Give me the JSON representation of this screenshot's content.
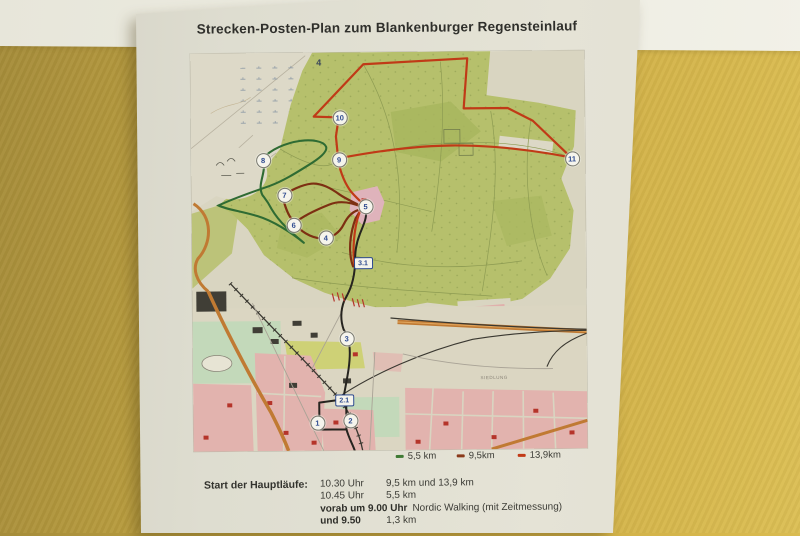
{
  "wall": {
    "band_color": "#f1f0e7",
    "yellow_color": "#ccab44"
  },
  "poster": {
    "title": "Strecken-Posten-Plan zum Blankenburger Regensteinlauf",
    "legend": {
      "items": [
        {
          "label": "5,5 km",
          "color": "#3f7a35"
        },
        {
          "label": "9,5km",
          "color": "#8a3a1a"
        },
        {
          "label": "13,9km",
          "color": "#c23a17"
        }
      ]
    },
    "schedule": {
      "heading": "Start der Hauptläufe:",
      "rows": [
        {
          "time": "10.30 Uhr",
          "detail": "9,5 km und 13,9 km"
        },
        {
          "time": "10.45 Uhr",
          "detail": "5,5 km"
        },
        {
          "time": "vorab um 9.00 Uhr",
          "detail": "Nordic Walking (mit Zeitmessung)"
        },
        {
          "time": "und 9.50",
          "detail": "1,3 km"
        }
      ]
    },
    "map": {
      "compartment_label": "4",
      "town_label": "SIEDLUNG",
      "routes": [
        {
          "name": "route-5-5km",
          "color": "#2f6b33"
        },
        {
          "name": "route-9-5km",
          "color": "#7d2f12"
        },
        {
          "name": "route-13-9km",
          "color": "#c03a17"
        },
        {
          "name": "route-connection",
          "color": "#26241f"
        }
      ],
      "markers": [
        {
          "label": "1",
          "type": "circle",
          "x": 123,
          "y": 369
        },
        {
          "label": "2",
          "type": "circle",
          "x": 156,
          "y": 367
        },
        {
          "label": "2.1",
          "type": "square",
          "x": 150,
          "y": 347
        },
        {
          "label": "3",
          "type": "circle",
          "x": 153,
          "y": 285
        },
        {
          "label": "3.1",
          "type": "square",
          "x": 170,
          "y": 210
        },
        {
          "label": "4",
          "type": "circle",
          "x": 133,
          "y": 184
        },
        {
          "label": "5",
          "type": "circle",
          "x": 173,
          "y": 153
        },
        {
          "label": "6",
          "type": "circle",
          "x": 101,
          "y": 171
        },
        {
          "label": "7",
          "type": "circle",
          "x": 92,
          "y": 141
        },
        {
          "label": "8",
          "type": "circle",
          "x": 71,
          "y": 106
        },
        {
          "label": "9",
          "type": "circle",
          "x": 147,
          "y": 106
        },
        {
          "label": "10",
          "type": "circle",
          "x": 148,
          "y": 64
        },
        {
          "label": "11",
          "type": "circle",
          "x": 380,
          "y": 107
        }
      ]
    }
  }
}
